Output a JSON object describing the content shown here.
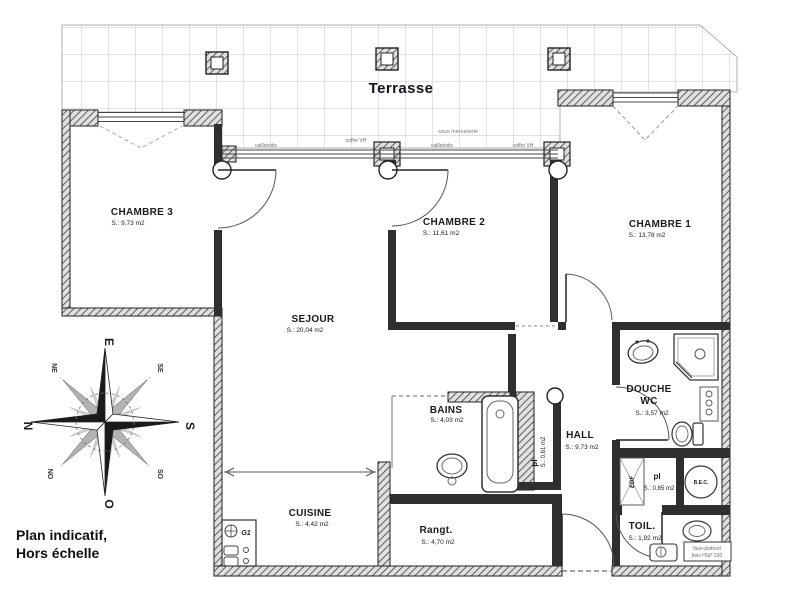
{
  "terrace": {
    "label": "Terrasse"
  },
  "note": {
    "line1": "Plan indicatif,",
    "line2": "Hors échelle"
  },
  "rooms": {
    "chambre3": {
      "name": "CHAMBRE 3",
      "area": "S.: 9,73 m2"
    },
    "chambre2": {
      "name": "CHAMBRE 2",
      "area": "S.: 11,61 m2"
    },
    "chambre1": {
      "name": "CHAMBRE 1",
      "area": "S.: 13,78 m2"
    },
    "sejour": {
      "name": "SEJOUR",
      "area": "S.: 20,04 m2"
    },
    "bains": {
      "name": "BAINS",
      "area": "S.: 4,03 m2"
    },
    "hall": {
      "name": "HALL",
      "area": "S.: 9,73 m2"
    },
    "douche": {
      "name_line1": "DOUCHE",
      "name_line2": "WC",
      "area": "S.: 3,57 m2"
    },
    "pl_hall": {
      "name": "pl",
      "area": "S.: 0,61 m2"
    },
    "pl_wc": {
      "name": "pl",
      "area": "S.: 0,85 m2"
    },
    "toil": {
      "name": "TOIL.",
      "area": "S.: 1,92 m2"
    },
    "cuisine": {
      "name": "CUISINE",
      "area": "S.: 4,42 m2"
    },
    "rangt": {
      "name": "Rangt.",
      "area": "S.: 4,70 m2"
    }
  },
  "annotations": {
    "sous_menuiserie": "sous menuiserie",
    "caillebotis_left": "caillebotis",
    "caillebotis_mid": "caillebotis",
    "coffre_vh_left": "coffre VH",
    "coffre_vh_right": "coffre VH",
    "bec": "B.E.C.",
    "edf": "EDF",
    "g1": "G1",
    "faux_plafond_line1": "faux-plafond",
    "faux_plafond_line2": "bois HSP 230"
  },
  "compass": {
    "n": "N",
    "s": "S",
    "e": "E",
    "o": "O",
    "ne": "NE",
    "se": "SE",
    "no": "NO",
    "so": "SO"
  },
  "colors": {
    "ink": "#1c1c1c",
    "wall": "#2f2f2f",
    "grid": "#c6c6c6",
    "annotation": "#777777"
  }
}
